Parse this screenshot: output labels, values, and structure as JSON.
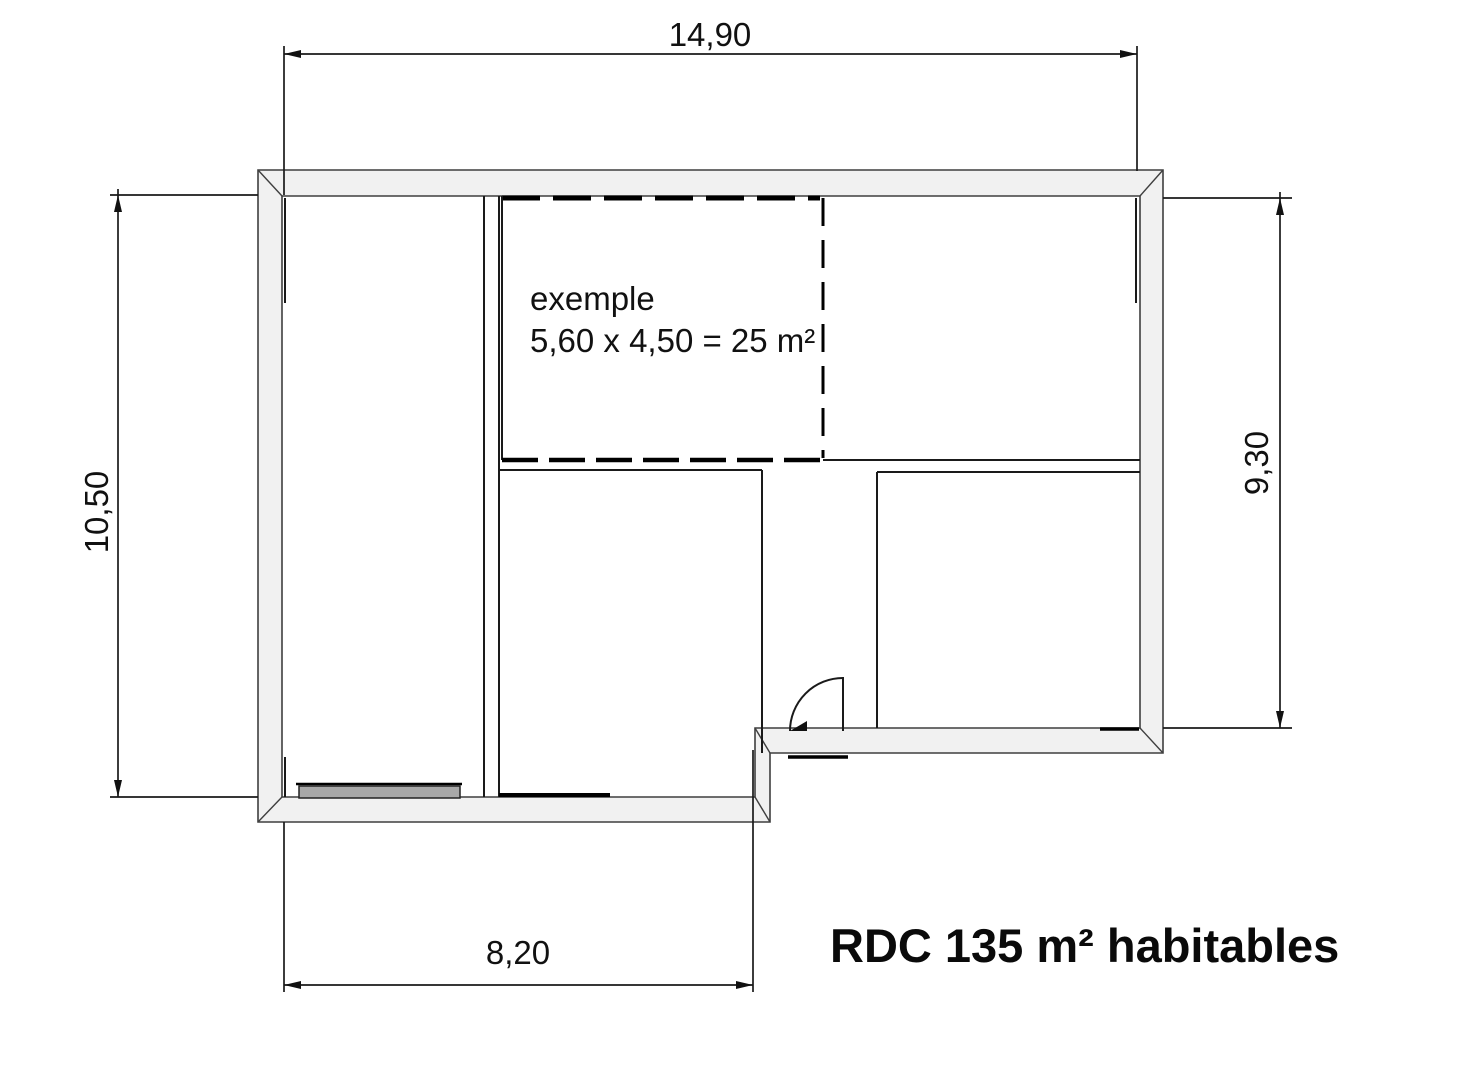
{
  "floor_plan": {
    "summary_label": "RDC 135 m² habitables",
    "example_room": {
      "label": "exemple",
      "calculation": "5,60 x 4,50 = 25 m²"
    },
    "dimensions_m": {
      "overall_width_top": "14,90",
      "overall_height_left": "10,50",
      "right_section_height": "9,30",
      "left_section_width_bottom": "8,20"
    },
    "colors": {
      "background": "#ffffff",
      "wall_fill": "#f1f1f1",
      "wall_outline": "#3f3f3f",
      "line": "#1a1a1a",
      "garage_sill_fill": "#a8a8a8"
    }
  }
}
